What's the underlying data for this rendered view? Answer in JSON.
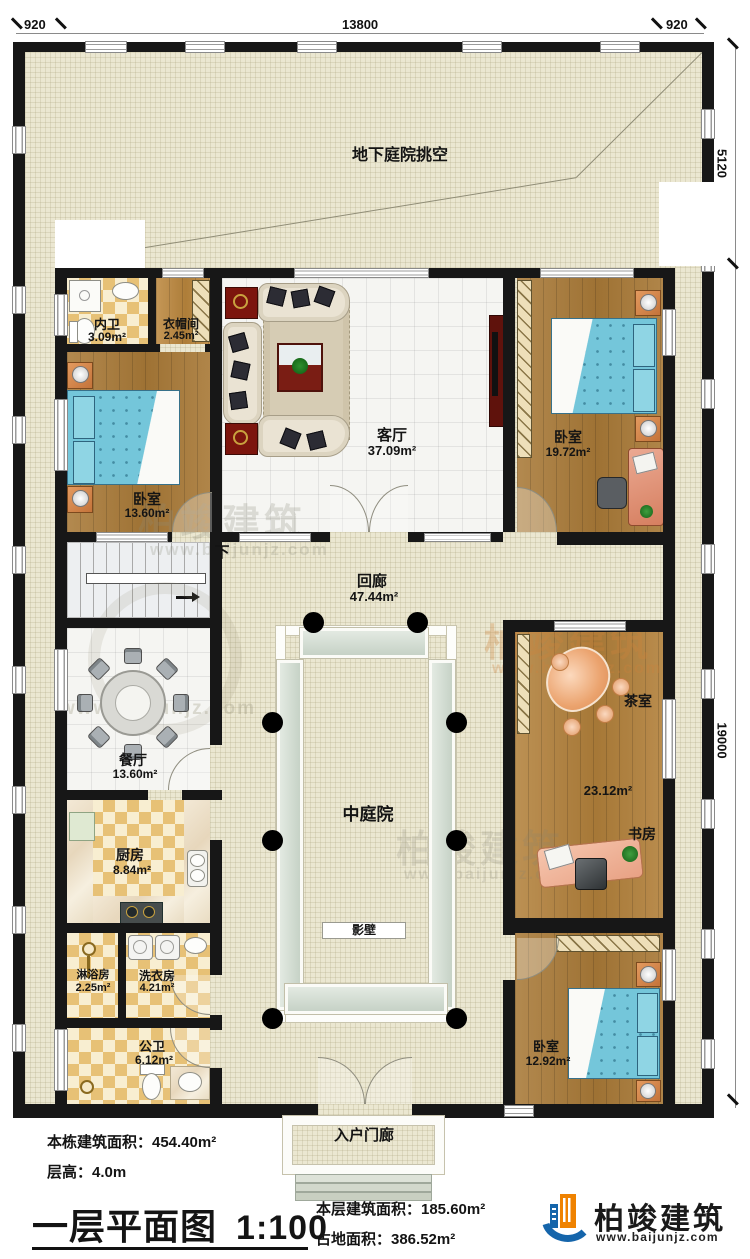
{
  "dimensions": {
    "top_left": "920",
    "top_middle": "13800",
    "top_right": "920",
    "right_top": "5120",
    "right_bottom": "19000"
  },
  "rooms": {
    "void": {
      "label": "地下庭院挑空"
    },
    "neiwei": {
      "label": "内卫",
      "area": "3.09m²"
    },
    "cloak": {
      "label": "衣帽间",
      "area": "2.45m²"
    },
    "bed_left": {
      "label": "卧室",
      "area": "13.60m²"
    },
    "living": {
      "label": "客厅",
      "area": "37.09m²"
    },
    "bed_right": {
      "label": "卧室",
      "area": "19.72m²"
    },
    "corridor": {
      "label": "回廊",
      "area": "47.44m²"
    },
    "stair": {
      "label": "下"
    },
    "dining": {
      "label": "餐厅",
      "area": "13.60m²"
    },
    "kitchen": {
      "label": "厨房",
      "area": "8.84m²"
    },
    "shower": {
      "label": "淋浴房",
      "area": "2.25m²"
    },
    "laundry": {
      "label": "洗衣房",
      "area": "4.21m²"
    },
    "pubbath": {
      "label": "公卫",
      "area": "6.12m²"
    },
    "tea": {
      "label": "茶室",
      "area": "23.12m²"
    },
    "study": {
      "label": "书房"
    },
    "courtyard": {
      "label": "中庭院"
    },
    "screenwall": {
      "label": "影壁"
    },
    "bed_bottom": {
      "label": "卧室",
      "area": "12.92m²"
    },
    "porch": {
      "label": "入户门廊"
    }
  },
  "footer": {
    "total_area": "本栋建筑面积：454.40m²",
    "floor_height": "层高：4.0m",
    "title": "一层平面图",
    "scale": "1:100",
    "floor_area": "本层建筑面积：185.60m²",
    "land_area": "占地面积：386.52m²"
  },
  "brand": {
    "name": "柏竣建筑",
    "url": "www.baijunjz.com"
  }
}
